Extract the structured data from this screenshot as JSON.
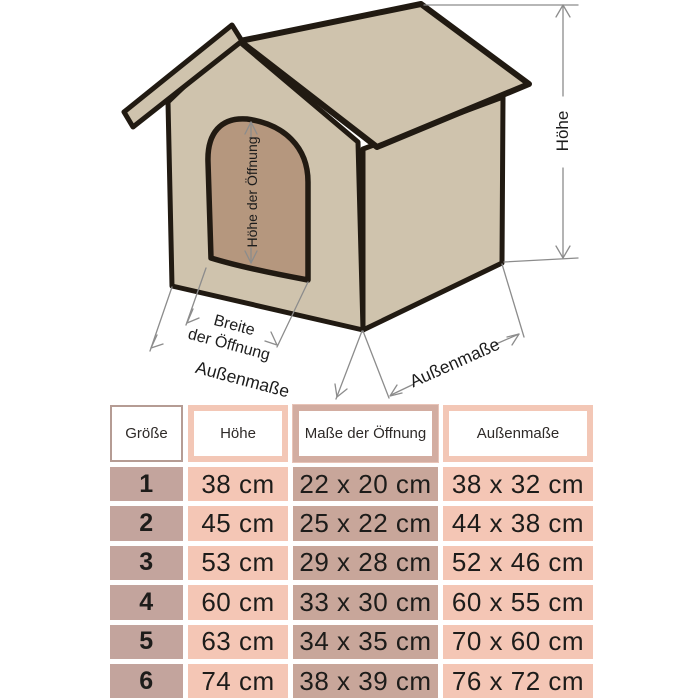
{
  "diagram": {
    "labels": {
      "hoehe": "Höhe",
      "hoehe_der_oeffnung": "Höhe der Öffnung",
      "breite_line1": "Breite",
      "breite_line2": "der Öffnung",
      "aussenmasse_left": "Außenmaße",
      "aussenmasse_right": "Außenmaße"
    },
    "colors": {
      "roof_fill": "#cfc3ad",
      "wall_fill": "#cfc3ad",
      "door_fill": "#b5977e",
      "outline": "#211a12",
      "dimension_line": "#8c8c8c"
    }
  },
  "table": {
    "headers": [
      "Größe",
      "Höhe",
      "Maße der Öffnung",
      "Außenmaße"
    ],
    "rows": [
      {
        "size": "1",
        "hoehe": "38 cm",
        "oeffnung": "22 x 20 cm",
        "aussen": "38 x 32 cm"
      },
      {
        "size": "2",
        "hoehe": "45 cm",
        "oeffnung": "25 x 22 cm",
        "aussen": "44 x 38 cm"
      },
      {
        "size": "3",
        "hoehe": "53 cm",
        "oeffnung": "29 x 28 cm",
        "aussen": "52 x 46 cm"
      },
      {
        "size": "4",
        "hoehe": "60 cm",
        "oeffnung": "33 x 30 cm",
        "aussen": "60 x 55 cm"
      },
      {
        "size": "5",
        "hoehe": "63 cm",
        "oeffnung": "34 x 35 cm",
        "aussen": "70 x 60 cm"
      },
      {
        "size": "6",
        "hoehe": "74 cm",
        "oeffnung": "38 x 39 cm",
        "aussen": "76 x 72 cm"
      }
    ],
    "colors": {
      "size_col": "#c3a49d",
      "hoehe_col": "#f4c6b5",
      "oeffnung_col": "#c8a69a",
      "aussen_col": "#f4c6b5"
    }
  }
}
